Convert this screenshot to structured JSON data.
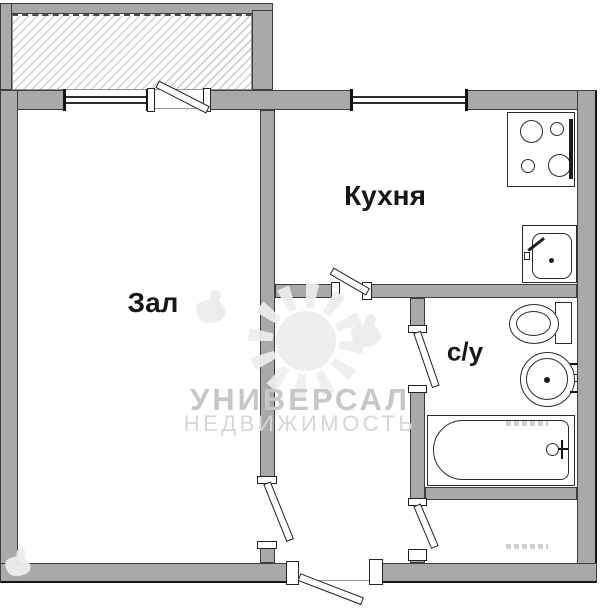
{
  "plan": {
    "rooms": [
      {
        "id": "zal",
        "label": "Зал"
      },
      {
        "id": "kitchen",
        "label": "Кухня"
      },
      {
        "id": "bathroom",
        "label": "с/у"
      }
    ],
    "fixtures": [
      "stove",
      "kitchen-sink",
      "toilet",
      "washbasin",
      "bathtub"
    ],
    "openings": [
      "balcony-window",
      "balcony-door",
      "kitchen-window",
      "kitchen-door",
      "living-room-door",
      "bathroom-door",
      "storage-door",
      "entrance-door"
    ]
  },
  "watermark": {
    "line1": "УНИВЕРСАЛ",
    "line2": "НЕДВИЖИМОСТЬ"
  },
  "colors": {
    "wall_fill": "#a9a9a9",
    "wall_outline": "#3e3e3e",
    "balcony_hatch_line": "#ccd4cc",
    "label_text": "#171717",
    "watermark_main": "#c7c7c7",
    "watermark_sub": "#d6d6d6",
    "background": "#ffffff"
  }
}
